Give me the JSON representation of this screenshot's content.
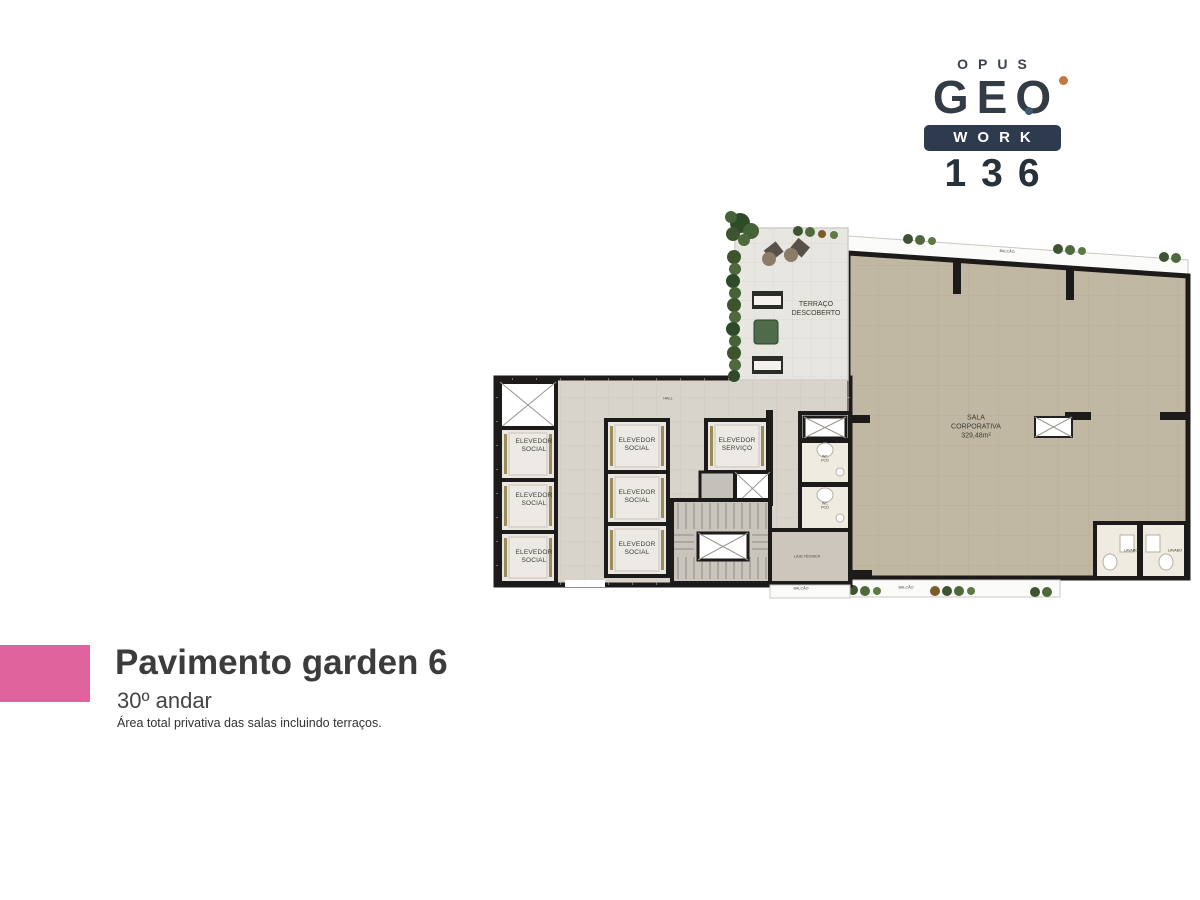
{
  "colors": {
    "accent-pink": "#e0639d",
    "brand-navy": "#2e3b4e",
    "brand-dark": "#333c44",
    "brand-orange": "#c1783c",
    "brand-blue-dot": "#3d5a73",
    "wall": "#1d1b19",
    "room-fill": "#c1b8a3",
    "core-fill": "#d9d4cb",
    "terrace-fill": "#e8e6e1",
    "cab-fill": "#eae7e2",
    "stair-fill": "#c9c5bd",
    "wc-fill": "#f0ebe1",
    "plant-green": "#4a6336"
  },
  "logo": {
    "brand": "OPUS",
    "name": "GEO",
    "work": "WORK",
    "number": "136"
  },
  "plan": {
    "labels": {
      "hall": "HALL",
      "elevator_social": "ELEVEDOR\nSOCIAL",
      "elevator_servico": "ELEVEDOR\nSERVIÇO",
      "terrace": "TERRAÇO\nDESCOBERTO",
      "sala": "SALA\nCORPORATIVA\n329,48m²",
      "wc": "WC\nPCD",
      "lavabo": "LAVABO",
      "laje": "LAJE TÉCNICA",
      "balcao": "BALCÃO"
    }
  },
  "title_block": {
    "title": "Pavimento garden 6",
    "subtitle": "30º andar",
    "note": "Área total privativa das salas incluindo terraços."
  }
}
